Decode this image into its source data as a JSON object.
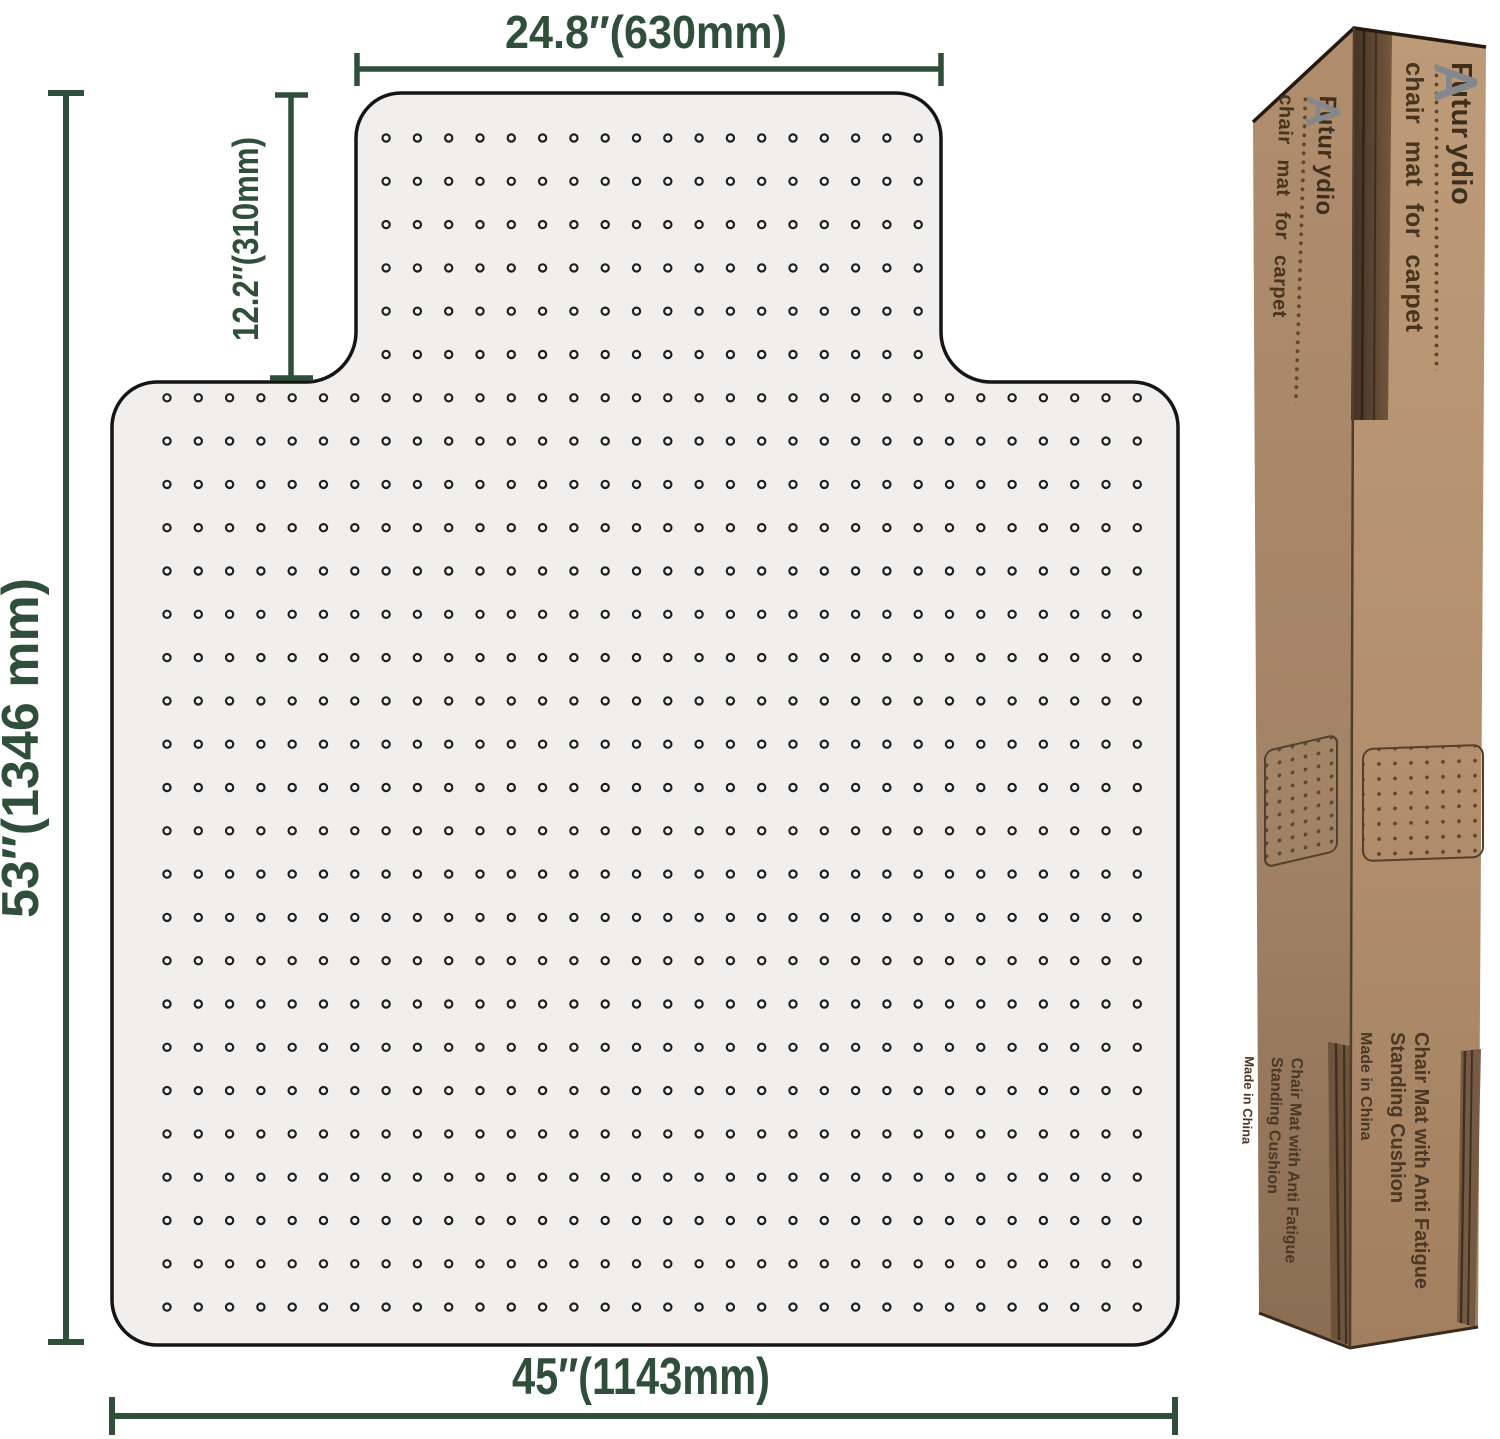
{
  "page": {
    "background": "#ffffff"
  },
  "diagram": {
    "accent_color": "#2f4f3b",
    "mat_fill": "#f0efed",
    "dimensions": {
      "top_width": "24.8″(630mm)",
      "lip_depth": "12.2″(310mm)",
      "total_height": "53″(1346 mm)",
      "bottom_width": "45″(1143mm)"
    }
  },
  "box": {
    "cardboard_color": "#b5946f",
    "brand_prefix": "Futur",
    "brand_suffix": "ydio",
    "logo_icon": "aydio-a-logo",
    "tagline": "chair mat for carpet",
    "features": {
      "line1": "Chair Mat with Anti Fatigue",
      "line2": "Standing Cushion",
      "origin": "Made in China"
    }
  }
}
